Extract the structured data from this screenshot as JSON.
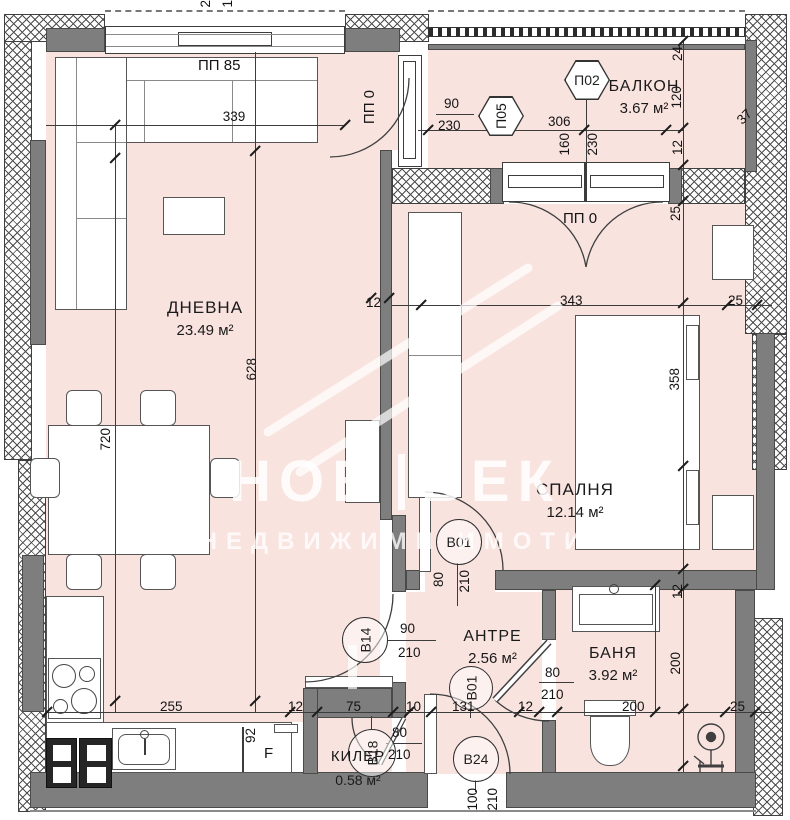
{
  "plan": {
    "rooms": {
      "living": {
        "name": "ДНЕВНА",
        "area": "23.49 м²"
      },
      "bedroom": {
        "name": "СПАЛНЯ",
        "area": "12.14 м²"
      },
      "balcony": {
        "name": "БАЛКОН",
        "area": "3.67 м²"
      },
      "hall": {
        "name": "АНТРЕ",
        "area": "2.56 м²"
      },
      "bathroom": {
        "name": "БАНЯ",
        "area": "3.92 м²"
      },
      "closet": {
        "name": "КИЛЕР",
        "area": "0.58 м²"
      }
    },
    "window_marks": {
      "pp85": "ПП 85",
      "pp0_living": "ПП 0",
      "pp0_bedroom": "ПП 0"
    },
    "panel_tags": {
      "p02": "П02",
      "p05": "П05"
    },
    "door_tags": {
      "b01_bedroom": "В01",
      "b14": "В14",
      "b01_hall": "В01",
      "b24": "В24",
      "b18": "В18"
    },
    "fixtures": {
      "fridge": "F"
    },
    "dims": {
      "edge_cut_a": "2",
      "edge_cut_b": "1",
      "living_window": "339",
      "living_depth": "628",
      "living_width": "720",
      "balc_door_w": "90",
      "balc_door_h": "230",
      "balcony_w": "306",
      "balc2_w": "160",
      "balc2_h": "230",
      "r_24": "24",
      "r_120": "120",
      "r_12": "12",
      "r_37": "37",
      "r_25": "25",
      "bed_w": "343",
      "bed_side": "25",
      "bed_d": "358",
      "wall_t": "12",
      "bath_t": "12",
      "bath_d": "200",
      "c_255": "255",
      "c_12": "12",
      "c_75": "75",
      "c_10": "10",
      "c_131": "131",
      "c_12b": "12",
      "c_200": "200",
      "c_25": "25",
      "f_92": "92",
      "bed_door_w": "80",
      "bed_door_h": "210",
      "liv_door_w": "90",
      "liv_door_h": "210",
      "bath_door_w": "80",
      "bath_door_h": "210",
      "clo_door_w": "80",
      "clo_door_h": "210",
      "ent_door_w": "100",
      "ent_door_h": "210"
    }
  },
  "watermark": {
    "brand_left": "НОВ",
    "brand_right": "ВЕК",
    "tagline": "НЕДВИЖИМИ ИМОТИ"
  },
  "colors": {
    "room_fill": "#f8e3df",
    "wall": "#7e7e7e",
    "line": "#3c3c3c"
  }
}
